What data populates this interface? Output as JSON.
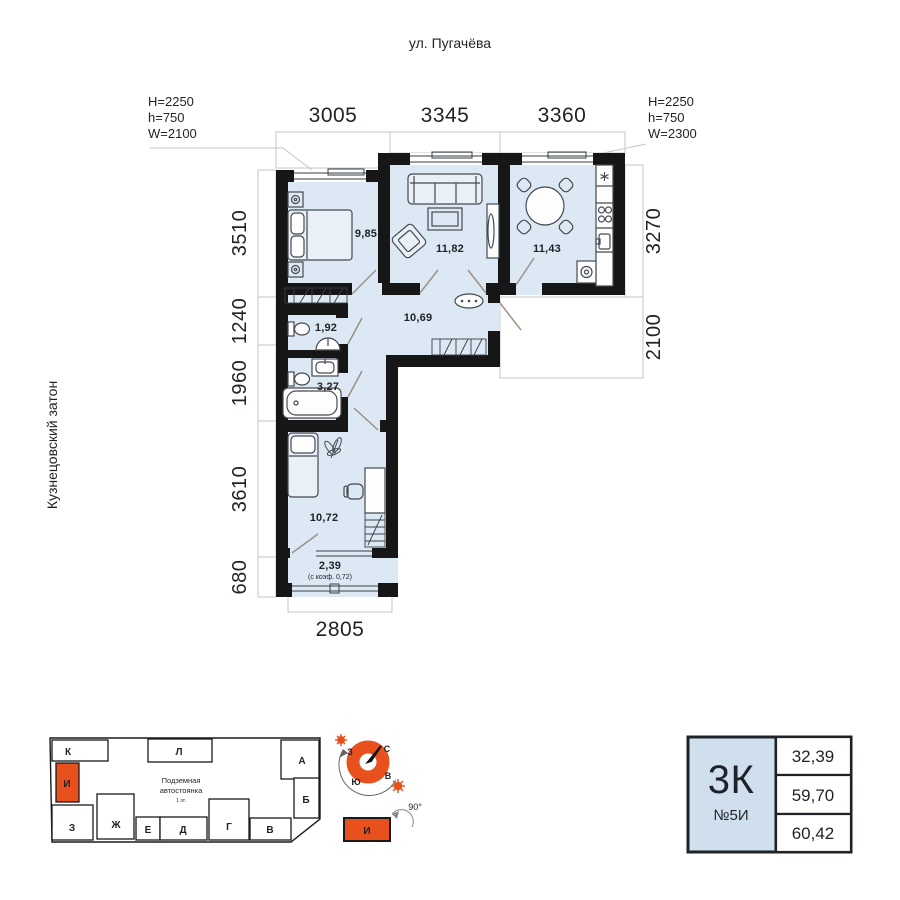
{
  "street_label": "ул. Пугачёва",
  "district_label": "Кузнецовский затон",
  "window_specs": {
    "left": {
      "H": "H=2250",
      "h": "h=750",
      "W": "W=2100"
    },
    "right": {
      "H": "H=2250",
      "h": "h=750",
      "W": "W=2300"
    }
  },
  "dimensions": {
    "top": [
      "3005",
      "3345",
      "3360"
    ],
    "left": [
      "3510",
      "1240",
      "1960",
      "3610",
      "680"
    ],
    "right": [
      "3270",
      "2100"
    ],
    "bottom": "2805"
  },
  "rooms": {
    "bedroom": "9,85",
    "living": "11,82",
    "kitchen": "11,43",
    "hall": "10,69",
    "wc": "1,92",
    "bath": "3,27",
    "bedroom2": "10,72",
    "balcony": "2,39",
    "balcony_note": "(с коэф. 0,72)"
  },
  "site_plan": {
    "blocks": [
      "К",
      "Л",
      "А",
      "И",
      "З",
      "Ж",
      "Е",
      "Д",
      "Г",
      "В",
      "Б"
    ],
    "center_label_1": "Подземная",
    "center_label_2": "автостоянка",
    "center_label_3": "1 эт.",
    "highlighted_block": "И"
  },
  "compass": {
    "n": "С",
    "s": "Ю",
    "w": "З",
    "e": "В",
    "rotation": "90°",
    "building": "И"
  },
  "info_card": {
    "type": "3К",
    "number": "№5И",
    "areas": [
      "32,39",
      "59,70",
      "60,42"
    ]
  },
  "colors": {
    "room_fill": "#dce8f3",
    "wall": "#161616",
    "accent": "#e8511d",
    "card_fill": "#cfdfee"
  }
}
